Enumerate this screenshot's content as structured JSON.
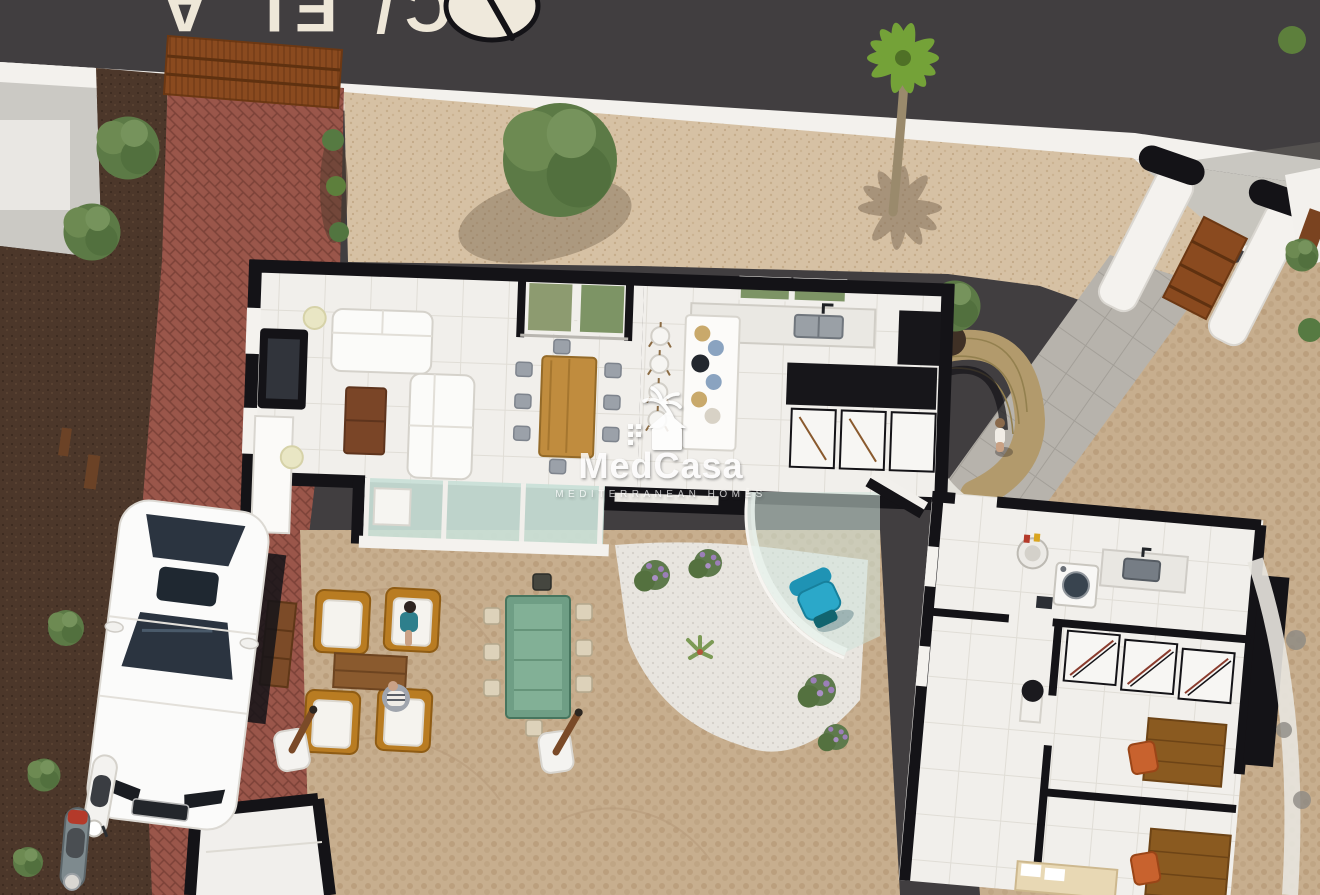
{
  "image": {
    "width": 1320,
    "height": 895,
    "kind": "3d-aerial-cutaway-floorplan-render"
  },
  "watermark": {
    "brand": "MedCasa",
    "tagline": "MEDITERRANEAN HOMES",
    "logo_icon": "palm-house-logo-icon",
    "color": "#ffffff"
  },
  "street": {
    "painted_text": "C/ EL A",
    "road_symbol": "painted-disc-marking"
  },
  "scene": {
    "areas": [
      "street",
      "perimeter-wall",
      "gravel-garden",
      "neighbor-plot",
      "brick-driveway",
      "main-house",
      "living-room",
      "dining-area",
      "interior-patio",
      "kitchen",
      "glass-facade",
      "terrace",
      "outdoor-lounge",
      "outdoor-dining",
      "pool-lounge",
      "white-gravel-beds",
      "entrance-gate",
      "garden-path",
      "gabion-planter",
      "annex-house",
      "utility-room",
      "bathroom",
      "wardrobe-corridor",
      "bedroom-1",
      "bedroom-2",
      "storage-room"
    ],
    "objects": [
      "sofa",
      "coffee-table",
      "tv-unit",
      "floor-lamp",
      "dining-table",
      "dining-chair",
      "kitchen-island",
      "bar-stool",
      "kitchen-sink",
      "kitchen-counters",
      "window-planter",
      "lounge-armchair",
      "outdoor-coffee-table",
      "outdoor-dining-table",
      "outdoor-chair",
      "parasol-planter",
      "curved-glass-balustrade",
      "teal-armchair",
      "washing-machine",
      "boiler",
      "utility-sink",
      "wardrobe",
      "desk",
      "desk-chair",
      "bed",
      "washbasin",
      "driveway-gate",
      "pedestrian-gate",
      "gate-pillar"
    ],
    "people": [
      "person-sitting-armchair",
      "person-sitting-pouf",
      "person-walking-path"
    ],
    "vehicles": [
      "white-car",
      "white-scooter",
      "gray-scooter"
    ],
    "vegetation": [
      "olive-tree",
      "palm-tree",
      "garden-trees",
      "shrubs",
      "lavender",
      "aloe"
    ],
    "colors": {
      "asphalt": "#413e40",
      "road_paint": "#eee7d8",
      "perimeter_wall": "#f3f1ed",
      "gravel": "#d6c1a4",
      "white_gravel": "#e8e5df",
      "cobblestone": "#c7ae8e",
      "brick_driveway": "#9a564a",
      "mulch": "#4c372a",
      "house_floor": "#f1efeb",
      "cut_walls": "#141317",
      "wood_furniture": "#8a5a2e",
      "dining_wood": "#c08c3e",
      "glass": "#c9e0d7",
      "teal_chair": "#2ba8c9",
      "orange_chair": "#c8622e",
      "outdoor_table_glass": "#6f9e85",
      "corten_gate": "#8a4a1f",
      "tree_green": "#5c7a46",
      "palm_green": "#74a238"
    }
  }
}
